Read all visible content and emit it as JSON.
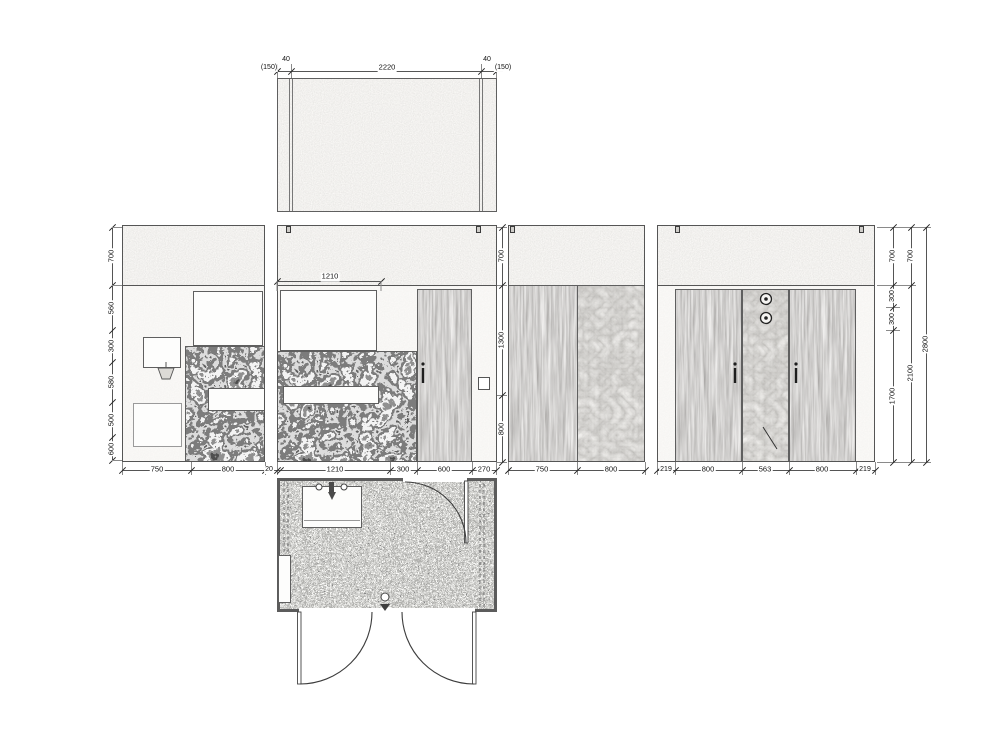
{
  "sheet": {
    "type": "bathroom unfolded plan and interior elevations",
    "colors": {
      "line": "#555555",
      "dim_text": "#111111",
      "paper": "#ffffff",
      "ceiling_fill": "#efede9",
      "wall_fill": "#f2f0ed",
      "wood_tone": "#8d8a84",
      "marble_tone": "#4a4a4a",
      "floor_tone": "#9a9a96"
    },
    "ceiling_plan": {
      "dims_top": [
        "(150)",
        "40",
        "2220",
        "40",
        "(150)"
      ]
    },
    "elevation_1": {
      "dims_left": [
        "700",
        "560",
        "300",
        "580",
        "500",
        "600"
      ],
      "dims_bottom": [
        "750",
        "800"
      ]
    },
    "elevation_2": {
      "dim_counter": "1210",
      "dims_right": [
        "700",
        "1300",
        "800"
      ],
      "dims_bottom": [
        "20",
        "1210",
        "300",
        "600",
        "270"
      ]
    },
    "elevation_3": {
      "dims_bottom": [
        "750",
        "800"
      ]
    },
    "elevation_4": {
      "dims_bottom": [
        "219",
        "800",
        "563",
        "800",
        "219"
      ],
      "dims_right_inner": [
        "700",
        "300",
        "300",
        "1700"
      ],
      "dims_right_middle": [
        "700",
        "2100"
      ],
      "dims_right_overall": [
        "2800"
      ]
    }
  }
}
